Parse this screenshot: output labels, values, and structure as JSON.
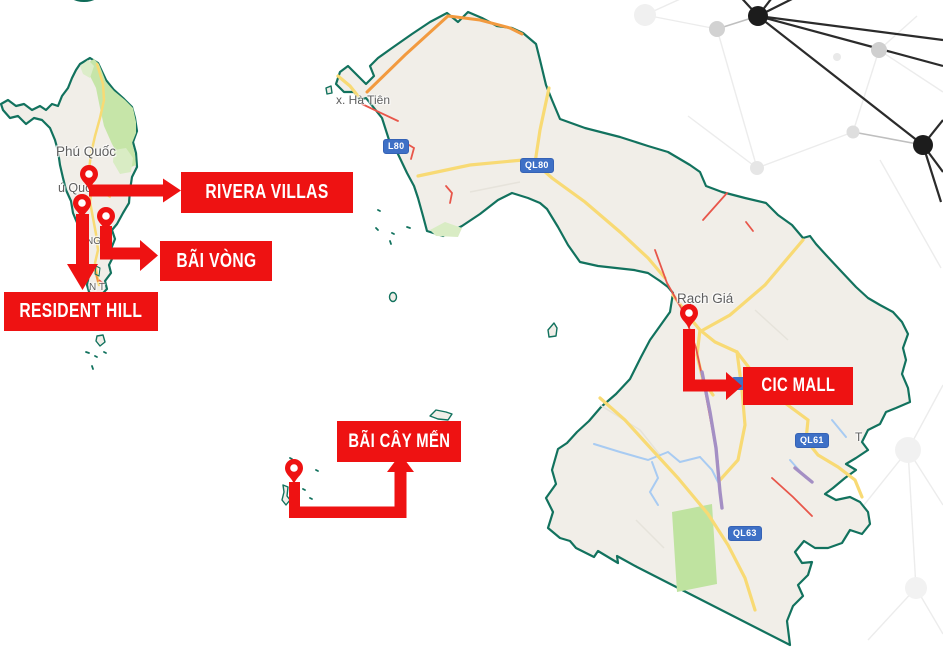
{
  "annotations": {
    "labels": [
      {
        "id": "rivera_villas",
        "text": "RIVERA VILLAS"
      },
      {
        "id": "bai_vong",
        "text": "BÃI VÒNG"
      },
      {
        "id": "resident_hill",
        "text": "RESIDENT HILL"
      },
      {
        "id": "bai_cay_men",
        "text": "BÃI CÂY MẾN"
      },
      {
        "id": "cic_mall",
        "text": "CIC MALL"
      }
    ]
  },
  "map": {
    "place_labels": [
      {
        "id": "phu_quoc_island",
        "text": "Phú Quốc"
      },
      {
        "id": "phu_quoc_town_partial",
        "text": "ú Quốc"
      },
      {
        "id": "duong_to_partial",
        "text": "NG T"
      },
      {
        "id": "an_thoi_partial",
        "text": "N T"
      },
      {
        "id": "ha_tien",
        "text": "x. Hà Tiên"
      },
      {
        "id": "rach_gia",
        "text": "Rạch Giá"
      },
      {
        "id": "t_partial",
        "text": "T"
      }
    ],
    "road_badges": [
      {
        "id": "ql80_clipped",
        "text": "L80"
      },
      {
        "id": "ql80",
        "text": "QL80"
      },
      {
        "id": "ql61",
        "text": "QL61"
      },
      {
        "id": "ql63",
        "text": "QL63"
      }
    ]
  },
  "colors": {
    "marker_red": "#EE1212",
    "border_teal": "#12725E",
    "land_fill": "#F1EEE8",
    "forest_green": "#C6E5A8",
    "forest_light": "#DCEDC9",
    "road_yellow": "#F8DA74",
    "road_orange": "#F29A3F",
    "road_red": "#E8564A",
    "road_purple": "#A48FC4",
    "canal_blue": "#A8CBF2",
    "badge_blue": "#3E70C6",
    "map_label_gray": "#5E5E5E",
    "network_dark": "#1C1C1C"
  }
}
